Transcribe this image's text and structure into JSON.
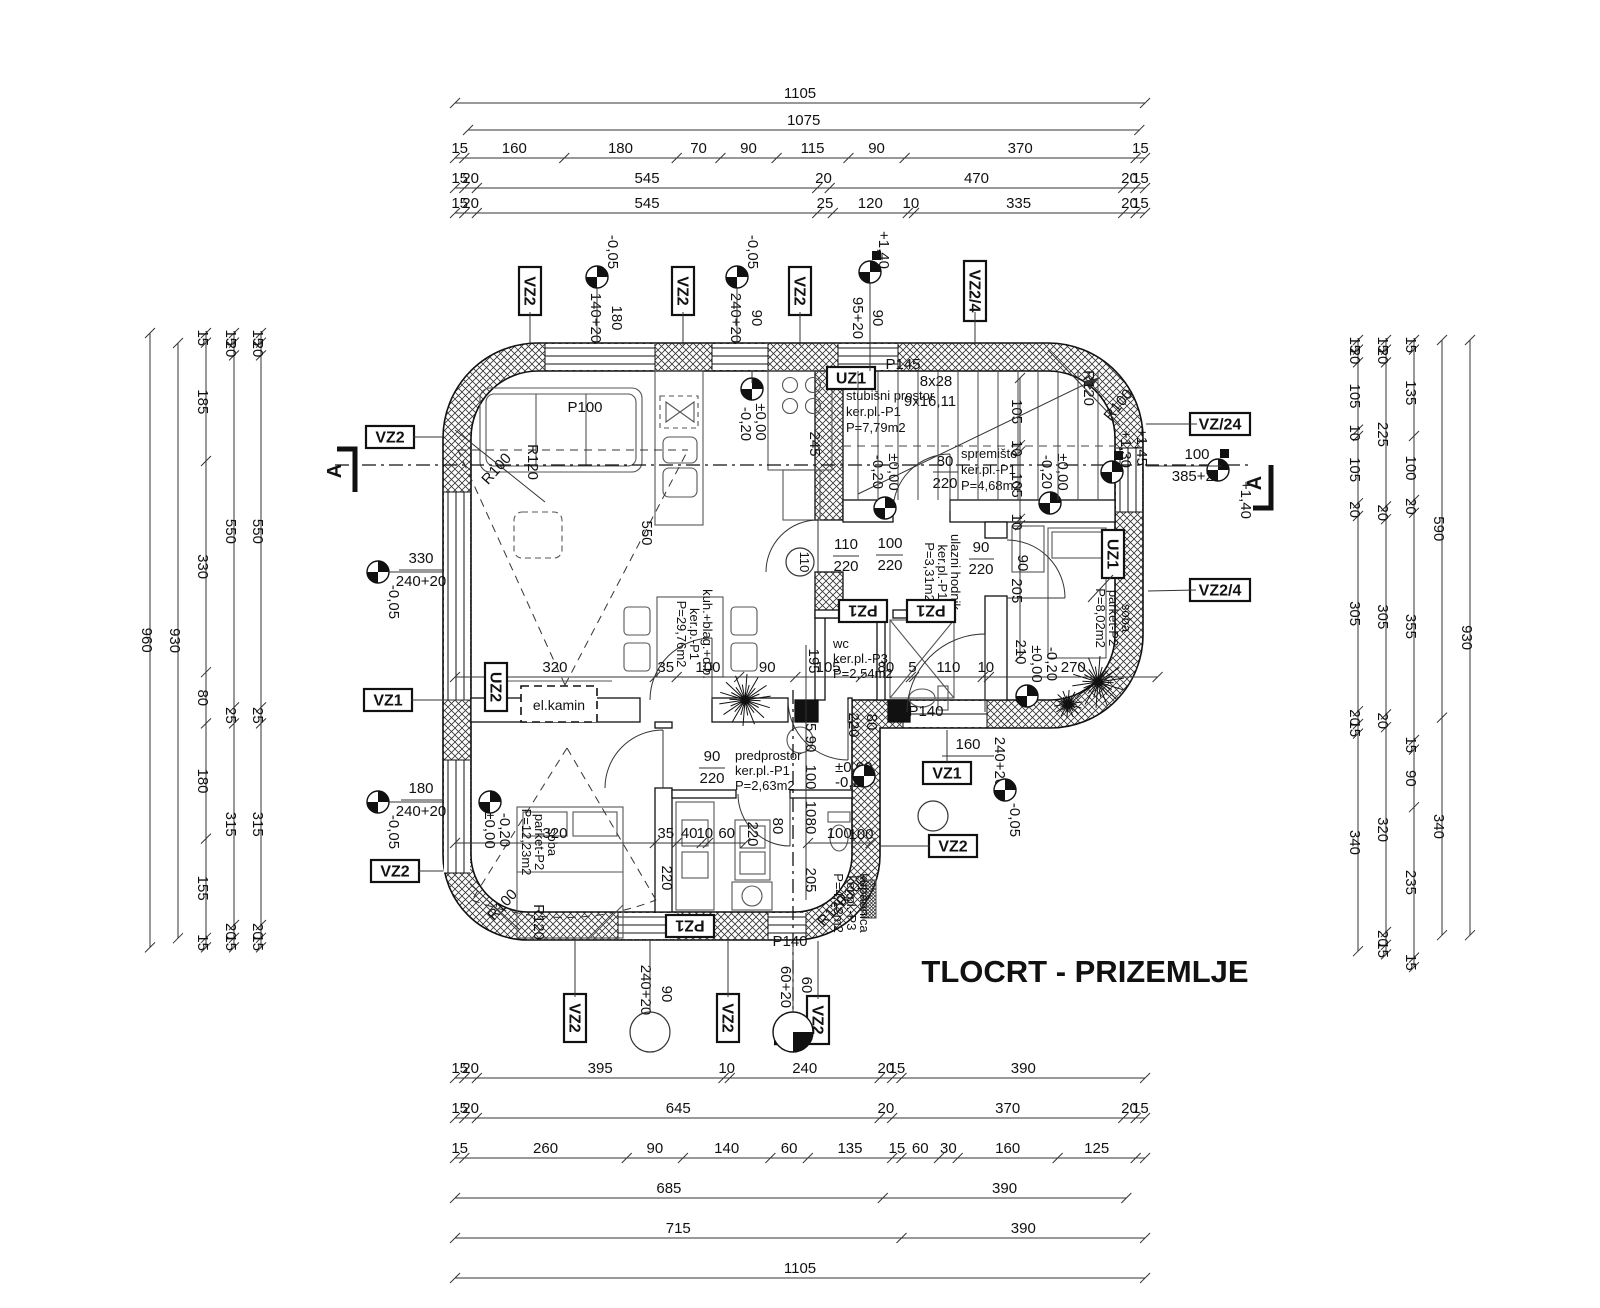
{
  "title": "TLOCRT - PRIZEMLJE",
  "colors": {
    "room_label": "#8d9cc0",
    "line": "#111111"
  },
  "sections": {
    "a": "A",
    "b": "B"
  },
  "markers": {
    "vz2": "VZ2",
    "vz24": "VZ2/4",
    "vz_24": "VZ/24",
    "vz1": "VZ1",
    "uz1": "UZ1",
    "uz2": "UZ2",
    "pz1": "PZ1"
  },
  "levels": {
    "zero": "±0,00",
    "minus020": "-0,20",
    "minus005": "-0,05",
    "plus140": "+1,40",
    "plus145": "+1,45",
    "plus130": "+1,30"
  },
  "rooms": {
    "stubisni": [
      "stubišni prostor",
      "ker.pl.-P1",
      "P=7,79m2"
    ],
    "spremiste": [
      "spremište",
      "ker.pl.-P1",
      "P=4,68m2"
    ],
    "soba1": [
      "soba",
      "parket-P2",
      "P=8,02m2"
    ],
    "hodnik": [
      "ulazni hodnik",
      "ker.pl.-P1",
      "P=3,31m2"
    ],
    "wc": [
      "wc",
      "ker.pl.-P3",
      "P=2,54m2"
    ],
    "dnevni": [
      "kuh.+blag.+d.b.",
      "ker.p.-P1",
      "P=29,76m2"
    ],
    "predprostor": [
      "predprostor",
      "ker.pl.-P1",
      "P=2,63m2"
    ],
    "soba2": [
      "soba",
      "parket-P2",
      "P=12,23m2"
    ],
    "kupaonica": [
      "kupaonica",
      "ker.pl.-P3",
      "P=4,13m2"
    ]
  },
  "ann": {
    "s140": "140+20",
    "s240": "240+20",
    "s95": "95+20",
    "s60": "60+20",
    "d385": "385+20",
    "w180": "180",
    "w90": "90",
    "w330": "330",
    "w160": "160",
    "w60": "60",
    "d80": "80",
    "h220": "220",
    "d110": "110",
    "d100": "100",
    "v550": "550",
    "v245": "245",
    "v195": "195",
    "v205": "205",
    "v210": "210",
    "v25": "25",
    "v10": "10",
    "p100": "P100",
    "p145": "P145",
    "p140": "P140",
    "r100": "R100",
    "r120": "R120",
    "stairs_run": "8x28",
    "stairs_rise": "9x16,11",
    "kamin": "el.kamin"
  },
  "dims": {
    "top": [
      {
        "id": "t1",
        "labels": [
          "1105"
        ]
      },
      {
        "id": "t2",
        "labels": [
          "1075"
        ]
      },
      {
        "id": "t3",
        "labels": [
          "15",
          "160",
          "180",
          "70",
          "90",
          "115",
          "90",
          "370",
          "15"
        ]
      },
      {
        "id": "t4",
        "labels": [
          "15",
          "20",
          "545",
          "20",
          "470",
          "20",
          "15"
        ]
      },
      {
        "id": "t5",
        "labels": [
          "15",
          "20",
          "545",
          "25",
          "120",
          "10",
          "335",
          "20",
          "15"
        ]
      }
    ],
    "bottom": [
      {
        "id": "b1",
        "labels": [
          "15",
          "20",
          "395",
          "10",
          "240",
          "20",
          "15",
          "390"
        ]
      },
      {
        "id": "b2",
        "labels": [
          "15",
          "20",
          "645",
          "20",
          "370",
          "20",
          "15"
        ]
      },
      {
        "id": "b3",
        "labels": [
          "15",
          "260",
          "90",
          "140",
          "60",
          "135",
          "15",
          "60",
          "30",
          "160",
          "125"
        ]
      },
      {
        "id": "b4",
        "labels": [
          "685",
          "390"
        ]
      },
      {
        "id": "b5",
        "labels": [
          "715",
          "390"
        ]
      },
      {
        "id": "b6",
        "labels": [
          "1105"
        ]
      }
    ],
    "left": [
      {
        "id": "l1",
        "labels": [
          "960"
        ]
      },
      {
        "id": "l2",
        "labels": [
          "930"
        ]
      },
      {
        "id": "l3",
        "labels": [
          "15",
          "185",
          "330",
          "80",
          "180",
          "155",
          "15"
        ]
      },
      {
        "id": "l4",
        "labels": [
          "15",
          "20",
          "550",
          "25",
          "315",
          "20",
          "15"
        ]
      },
      {
        "id": "l5",
        "labels": [
          "15",
          "20",
          "550",
          "25",
          "315",
          "20",
          "15"
        ]
      }
    ],
    "right": [
      {
        "id": "r1",
        "labels": [
          "15",
          "20",
          "105",
          "10",
          "105",
          "20",
          "305",
          "20",
          "15",
          "340"
        ]
      },
      {
        "id": "r2",
        "labels": [
          "15",
          "20",
          "225",
          "20",
          "305",
          "20",
          "320",
          "20",
          "15"
        ]
      },
      {
        "id": "r3",
        "labels": [
          "15",
          "135",
          "100",
          "20",
          "355",
          "15",
          "90",
          "235",
          "15"
        ]
      },
      {
        "id": "r4",
        "labels": [
          "590",
          "340"
        ]
      },
      {
        "id": "r5",
        "labels": [
          "930"
        ]
      }
    ],
    "inner": [
      {
        "id": "ic1",
        "labels": [
          "320",
          "35",
          "100",
          "90",
          "105",
          "80",
          "5",
          "110",
          "10",
          "270"
        ]
      },
      {
        "id": "ic2",
        "labels": [
          "320",
          "35",
          "40",
          "10",
          "60"
        ]
      },
      {
        "id": "ic3",
        "labels": [
          "100"
        ]
      },
      {
        "id": "ic4",
        "labels": [
          "105",
          "10",
          "105",
          "10",
          "205"
        ]
      }
    ]
  }
}
